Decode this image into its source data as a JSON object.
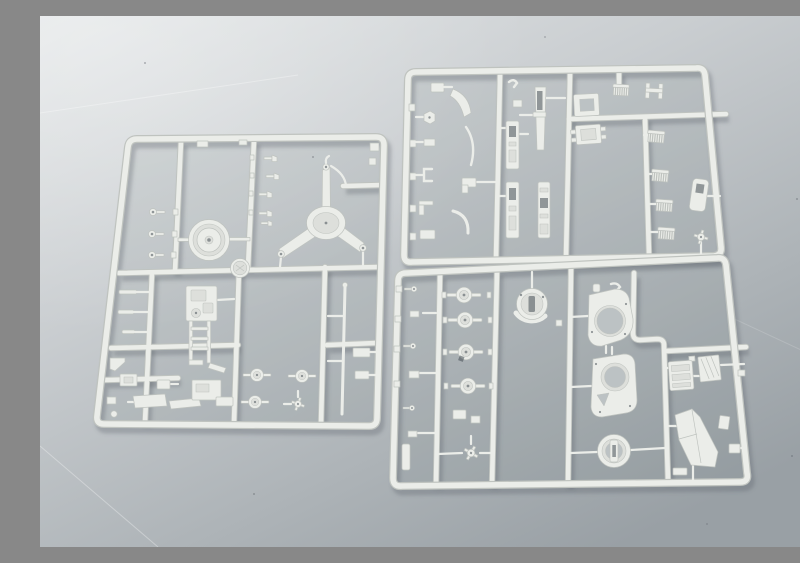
{
  "scene": {
    "type": "photograph",
    "subject": "Three light-gray injection-molded plastic model kit sprues (parts frames) laid flat on a neutral gray surface with soft studio lighting",
    "sprues": [
      {
        "id": "left",
        "position": "left",
        "description": "Large square sprue holding a circular turntable dish, a three-armed tripod star mount, a ladder frame plate, small eyelets, wheel hubs and assorted brackets"
      },
      {
        "id": "top-right",
        "position": "upper right",
        "description": "Rectangular sprue with slide-rail strips, a slotted barrel, open frame blocks, five leaf-spring comb parts, a side panel and many small fittings"
      },
      {
        "id": "bottom-right",
        "position": "lower right",
        "description": "Rectangular sprue with a column of round wheel hubs, a slotted crescent hub, two large ring gun-housing plates, a hub ring, an engine block, a striped plate and a fender panel"
      }
    ]
  },
  "theme": {
    "bg-top": "#e4e7e8",
    "bg-mid": "#c9cdd0",
    "bg-low": "#adb3b7",
    "bg-bottom": "#99a0a5",
    "plastic": "#ebede9",
    "plastic2": "#dddfdb",
    "edge": "#bfc3bf",
    "hole": "rgba(70,79,85,0.55)",
    "through": "#bcc2c4",
    "shadow": "rgba(85,94,99,0.30)",
    "interior": "rgba(120,132,136,0.15)",
    "highlight": "rgba(255,255,255,0.30)"
  }
}
